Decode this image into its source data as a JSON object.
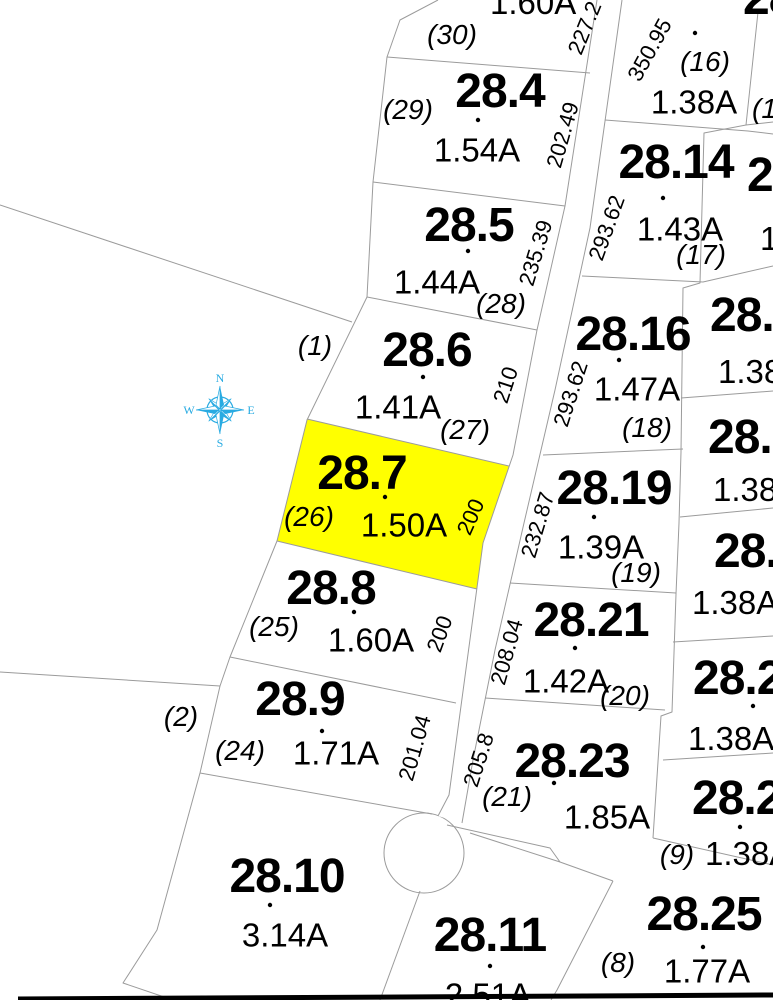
{
  "map": {
    "colors": {
      "highlight": "#FFFF00",
      "compass": "#29ABE2"
    },
    "compass": {
      "north": "N",
      "east": "E",
      "south": "S",
      "west": "W"
    },
    "out_lots": {
      "lot1": "(1)",
      "lot2": "(2)"
    },
    "center_parcels": [
      {
        "acreage": "1.60A",
        "lot": "(30)"
      },
      {
        "number": "28.4",
        "acreage": "1.54A",
        "lot": "(29)"
      },
      {
        "number": "28.5",
        "acreage": "1.44A",
        "lot": "(28)"
      },
      {
        "number": "28.6",
        "acreage": "1.41A",
        "lot": "(27)"
      },
      {
        "number": "28.7",
        "acreage": "1.50A",
        "lot": "(26)",
        "highlighted": true
      },
      {
        "number": "28.8",
        "acreage": "1.60A",
        "lot": "(25)"
      },
      {
        "number": "28.9",
        "acreage": "1.71A",
        "lot": "(24)"
      },
      {
        "number": "28.10",
        "acreage": "3.14A"
      },
      {
        "number": "28.11",
        "acreage": "2.51A"
      }
    ],
    "east_parcels": [
      {
        "acreage": "1.38A",
        "lot": "(16)"
      },
      {
        "number": "28.14",
        "acreage": "1.43A",
        "lot": "(17)"
      },
      {
        "number": "28.16",
        "acreage": "1.47A",
        "lot": "(18)"
      },
      {
        "number": "28.19",
        "acreage": "1.39A",
        "lot": "(19)"
      },
      {
        "number": "28.21",
        "acreage": "1.42A",
        "lot": "(20)"
      },
      {
        "number": "28.23",
        "acreage": "1.85A",
        "lot": "(21)"
      },
      {
        "number": "28.25",
        "acreage": "1.77A",
        "lot": "(8)"
      }
    ],
    "edge_parcels": {
      "top_number": "28.12",
      "items": [
        {
          "lot": "(1"
        },
        {
          "number": "2",
          "acreage": "1"
        },
        {
          "number": "28.",
          "acreage": "1.38"
        },
        {
          "number": "28.",
          "acreage": "1.38A"
        },
        {
          "number": "28.",
          "acreage": "1.38A"
        },
        {
          "number": "28.2",
          "acreage": "1.38A"
        },
        {
          "number": "28.2",
          "acreage": "1.38A",
          "lot": "(9)"
        }
      ]
    },
    "road_dims_left": [
      "227.2",
      "202.49",
      "235.39",
      "210",
      "200",
      "200",
      "201.04"
    ],
    "road_dims_right": [
      "350.95",
      "293.62",
      "293.62",
      "232.87",
      "208.04",
      "205.8"
    ]
  }
}
